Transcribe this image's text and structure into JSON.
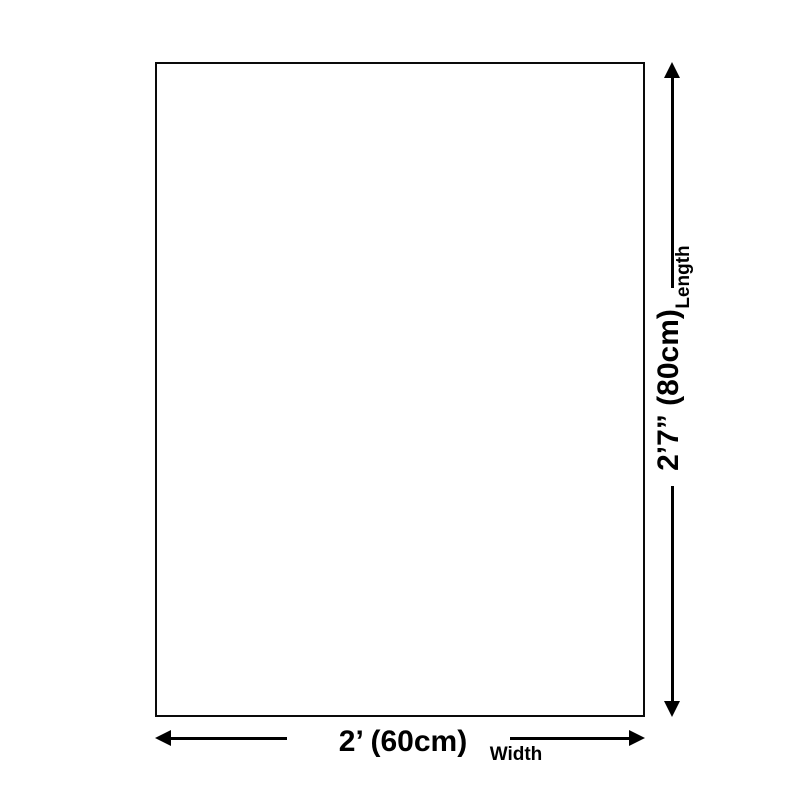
{
  "colors": {
    "ink": "#000000",
    "background": "#ffffff"
  },
  "diagram": {
    "shape": "rectangle-outline",
    "length": {
      "value": "2’7” (80cm)",
      "label": "Length"
    },
    "width": {
      "value": "2’ (60cm)",
      "label": "Width"
    }
  }
}
